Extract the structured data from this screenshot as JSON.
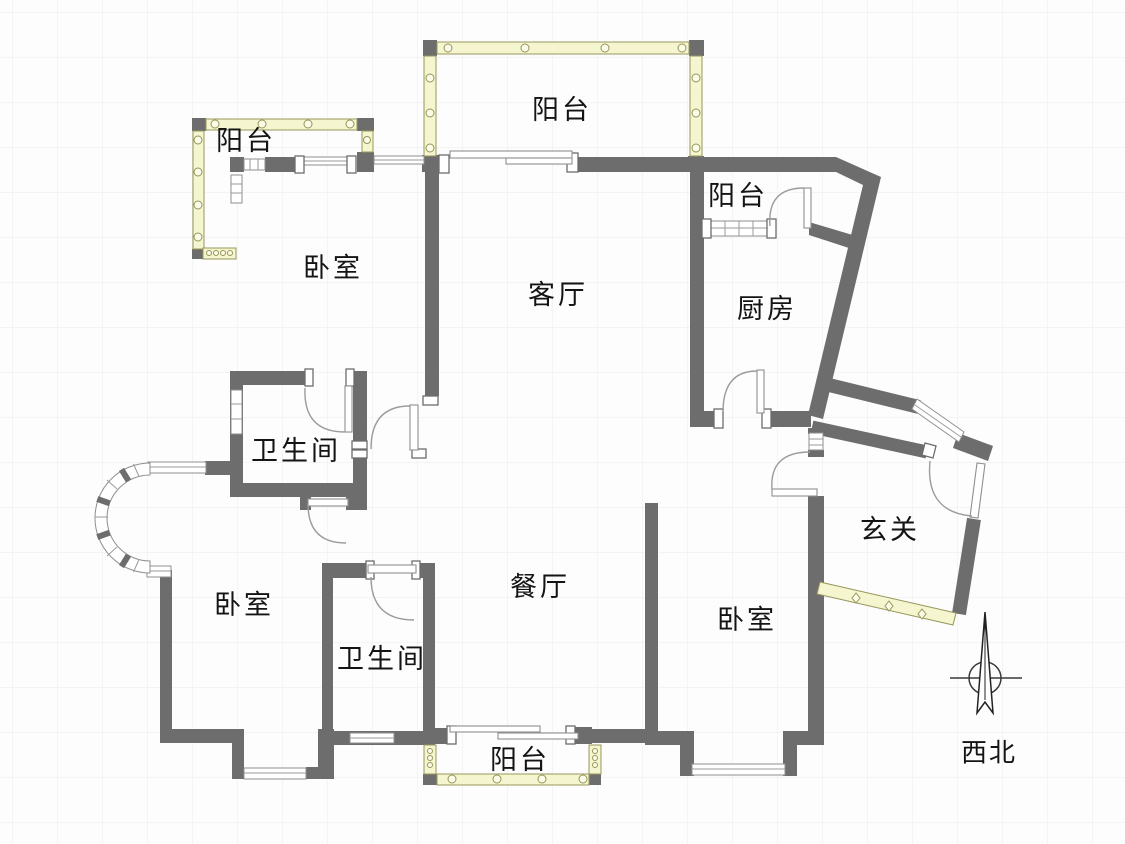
{
  "title": "apartment-floor-plan",
  "rooms": [
    {
      "id": "balcony-top-left",
      "label": "阳台",
      "x": 246,
      "y": 141
    },
    {
      "id": "balcony-top",
      "label": "阳台",
      "x": 562,
      "y": 110
    },
    {
      "id": "balcony-kitchen",
      "label": "阳台",
      "x": 738,
      "y": 196
    },
    {
      "id": "bedroom-north",
      "label": "卧室",
      "x": 333,
      "y": 268
    },
    {
      "id": "living-room",
      "label": "客厅",
      "x": 558,
      "y": 295
    },
    {
      "id": "kitchen",
      "label": "厨房",
      "x": 767,
      "y": 309
    },
    {
      "id": "bathroom-north",
      "label": "卫生间",
      "x": 296,
      "y": 451
    },
    {
      "id": "entry-hall",
      "label": "玄关",
      "x": 890,
      "y": 530
    },
    {
      "id": "bedroom-west",
      "label": "卧室",
      "x": 244,
      "y": 605
    },
    {
      "id": "dining-room",
      "label": "餐厅",
      "x": 540,
      "y": 587
    },
    {
      "id": "bathroom-south",
      "label": "卫生间",
      "x": 382,
      "y": 659
    },
    {
      "id": "bedroom-east",
      "label": "卧室",
      "x": 747,
      "y": 620
    },
    {
      "id": "balcony-bottom",
      "label": "阳台",
      "x": 520,
      "y": 760
    }
  ],
  "compass": {
    "label": "西北",
    "x": 989,
    "y": 753
  },
  "colors": {
    "bg": "#fdfdfd",
    "grid": "#eaeaea",
    "wall": "#6d6d6d",
    "glazing": "#f5f5cf",
    "glazing_border": "#96965a",
    "door": "#9b9b9b",
    "text": "#141414"
  }
}
